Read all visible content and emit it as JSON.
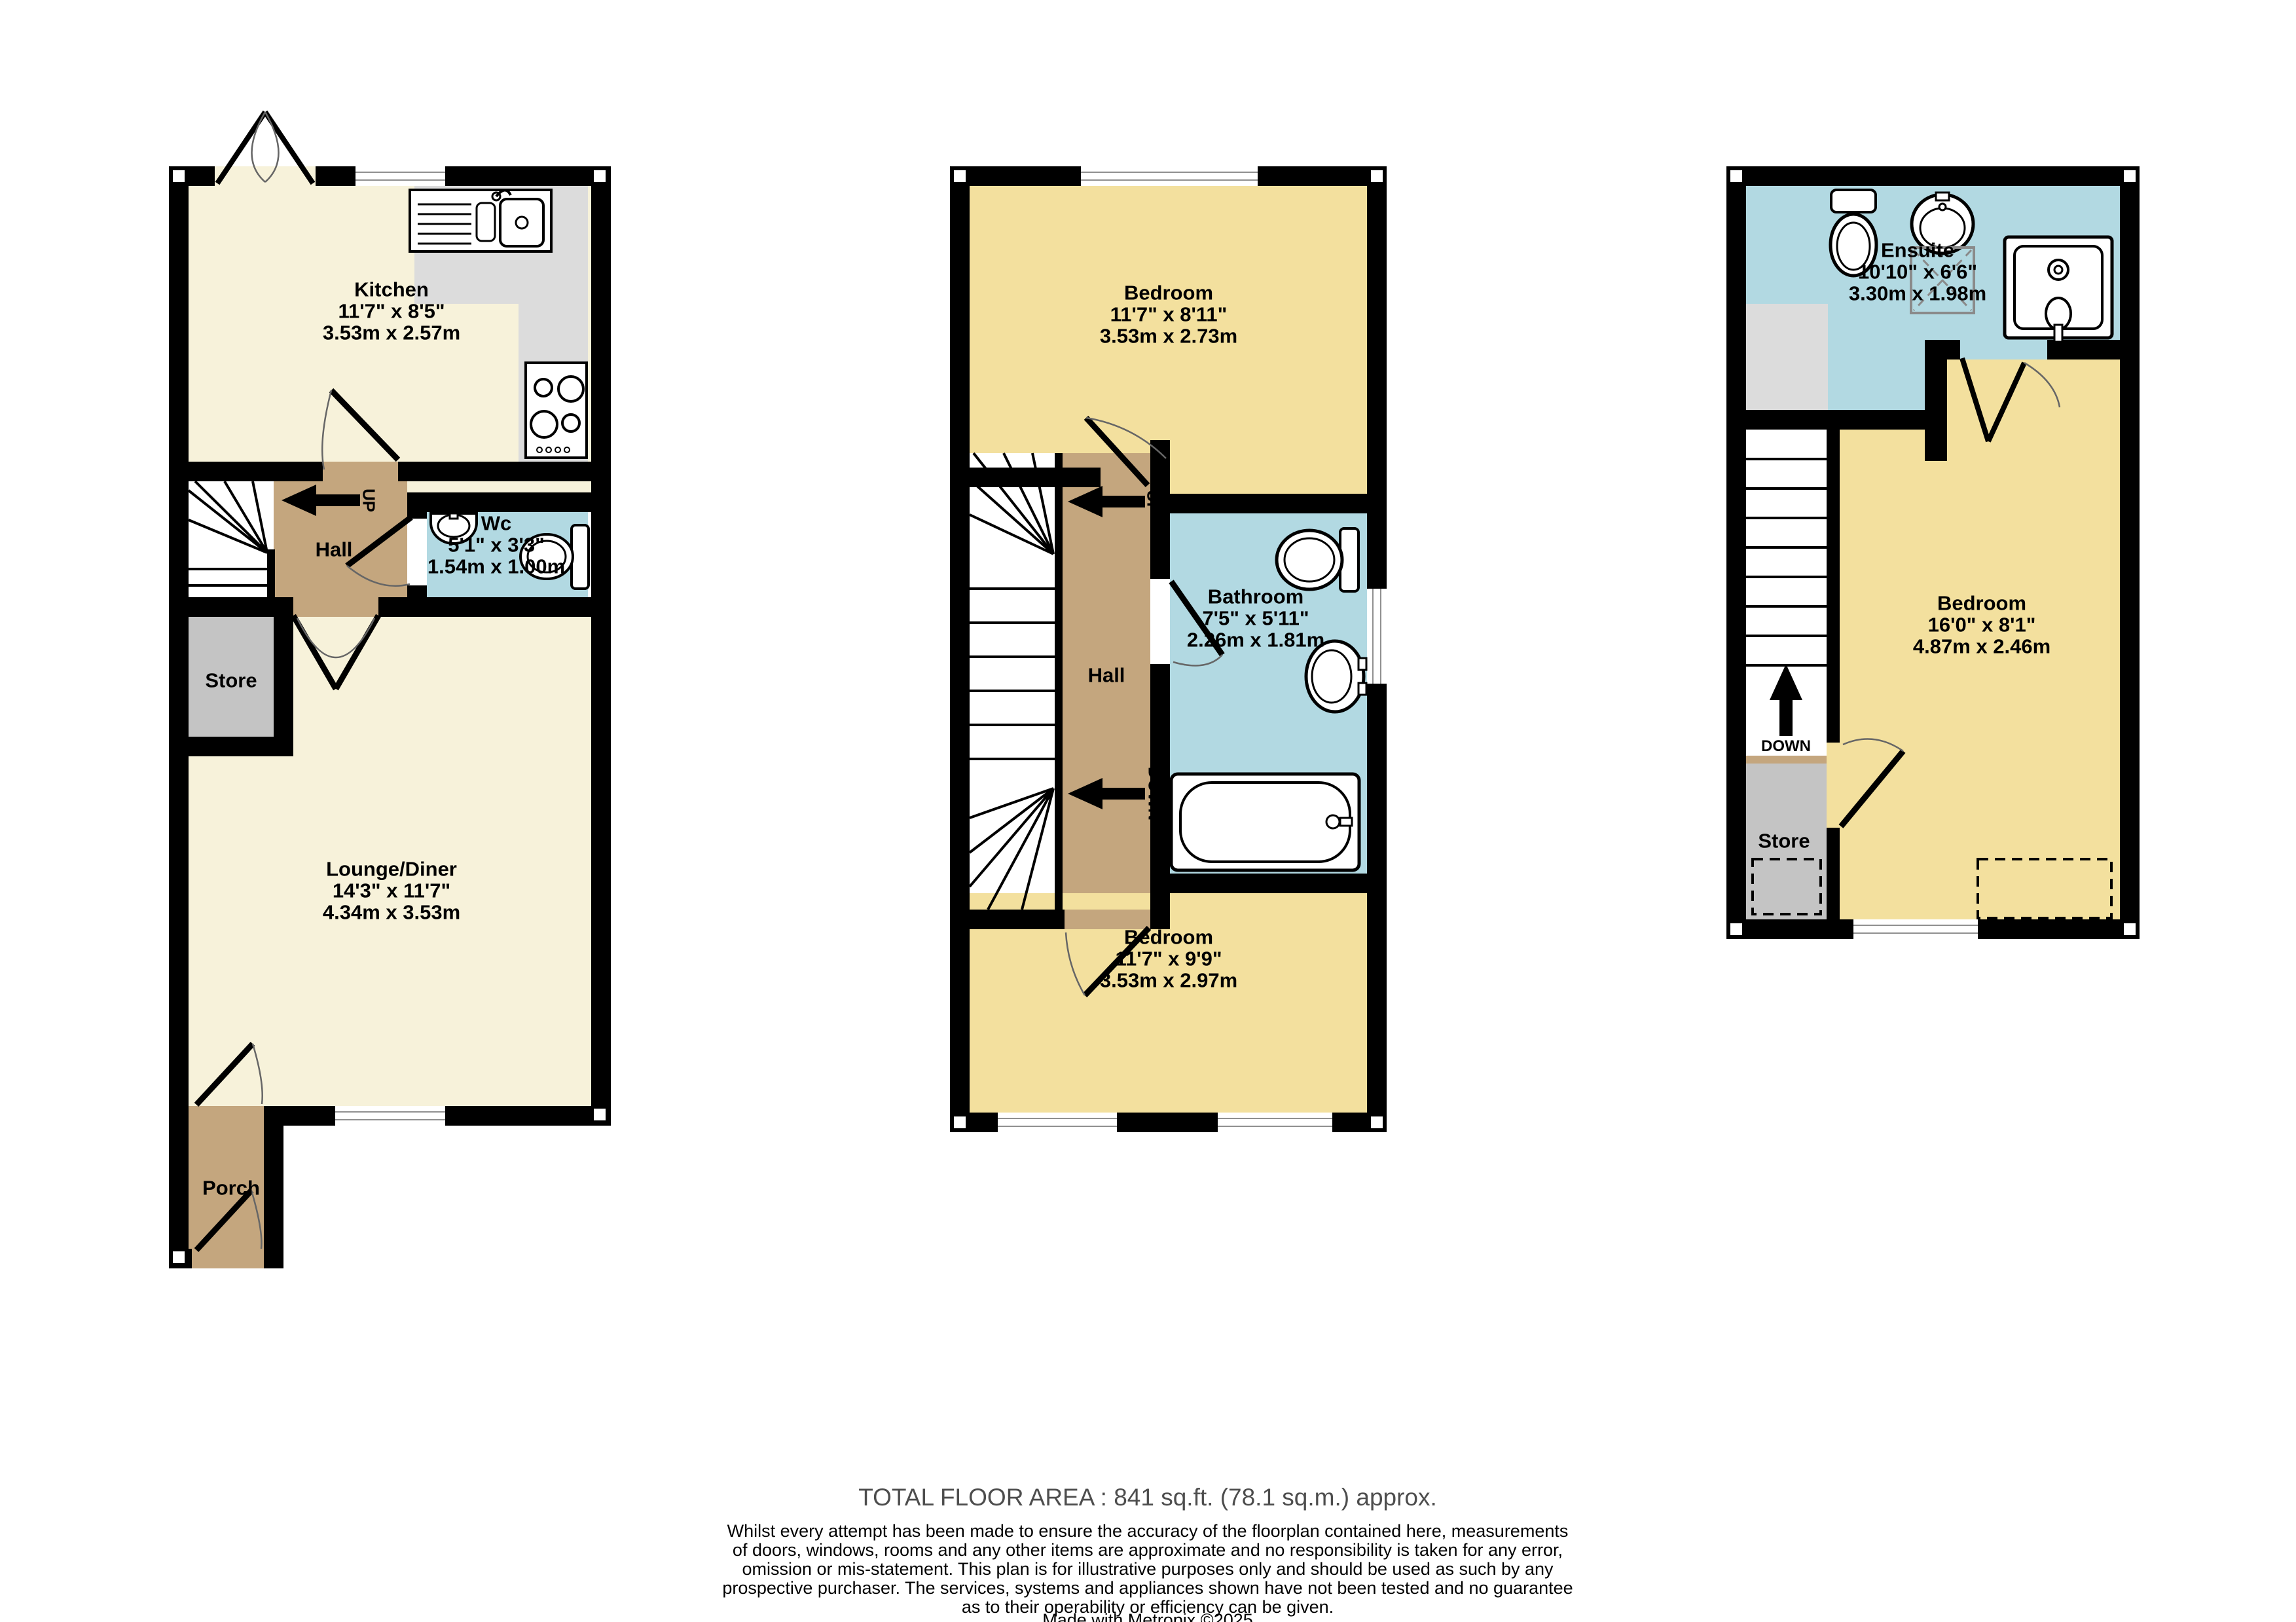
{
  "colors": {
    "wall": "#000000",
    "cream_room": "#f7f2da",
    "yellow_room": "#f3e09e",
    "blue_room": "#b2d9e2",
    "tan_room": "#c4a67e",
    "store_gray": "#c4c4c4",
    "counter_gray": "#dcdcdc",
    "window_line": "#909090",
    "footer_gray": "#4d4d4d"
  },
  "p1": {
    "kitchen": {
      "label": "Kitchen",
      "imp": "11'7\" x 8'5\"",
      "met": "3.53m x 2.57m"
    },
    "wc": {
      "label": "Wc",
      "imp": "5'1\" x 3'3\"",
      "met": "1.54m x 1.00m"
    },
    "hall": "Hall",
    "store": "Store",
    "lounge": {
      "label": "Lounge/Diner",
      "imp": "14'3\" x 11'7\"",
      "met": "4.34m x 3.53m"
    },
    "porch": "Porch",
    "up": "UP"
  },
  "p2": {
    "bed1": {
      "label": "Bedroom",
      "imp": "11'7\" x 8'11\"",
      "met": "3.53m x 2.73m"
    },
    "bath": {
      "label": "Bathroom",
      "imp": "7'5\" x 5'11\"",
      "met": "2.26m x 1.81m"
    },
    "hall": "Hall",
    "bed2": {
      "label": "Bedroom",
      "imp": "11'7\" x 9'9\"",
      "met": "3.53m x 2.97m"
    },
    "up": "UP",
    "down": "DOWN"
  },
  "p3": {
    "ensuite": {
      "label": "Ensuite",
      "imp": "10'10\" x 6'6\"",
      "met": "3.30m x 1.98m"
    },
    "bed": {
      "label": "Bedroom",
      "imp": "16'0\" x 8'1\"",
      "met": "4.87m x 2.46m"
    },
    "store": "Store",
    "down": "DOWN"
  },
  "footer": {
    "total": "TOTAL FLOOR AREA : 841 sq.ft. (78.1 sq.m.) approx.",
    "lines": [
      "Whilst every attempt has been made to ensure the accuracy of the floorplan contained here, measurements",
      "of doors, windows, rooms and any other items are approximate and no responsibility is taken for any error,",
      "omission or mis-statement. This plan is for illustrative purposes only and should be used as such by any",
      "prospective purchaser. The services, systems and appliances shown have not been tested and no guarantee",
      "as to their operability or efficiency can be given."
    ],
    "credit": "Made with Metropix ©2025"
  }
}
